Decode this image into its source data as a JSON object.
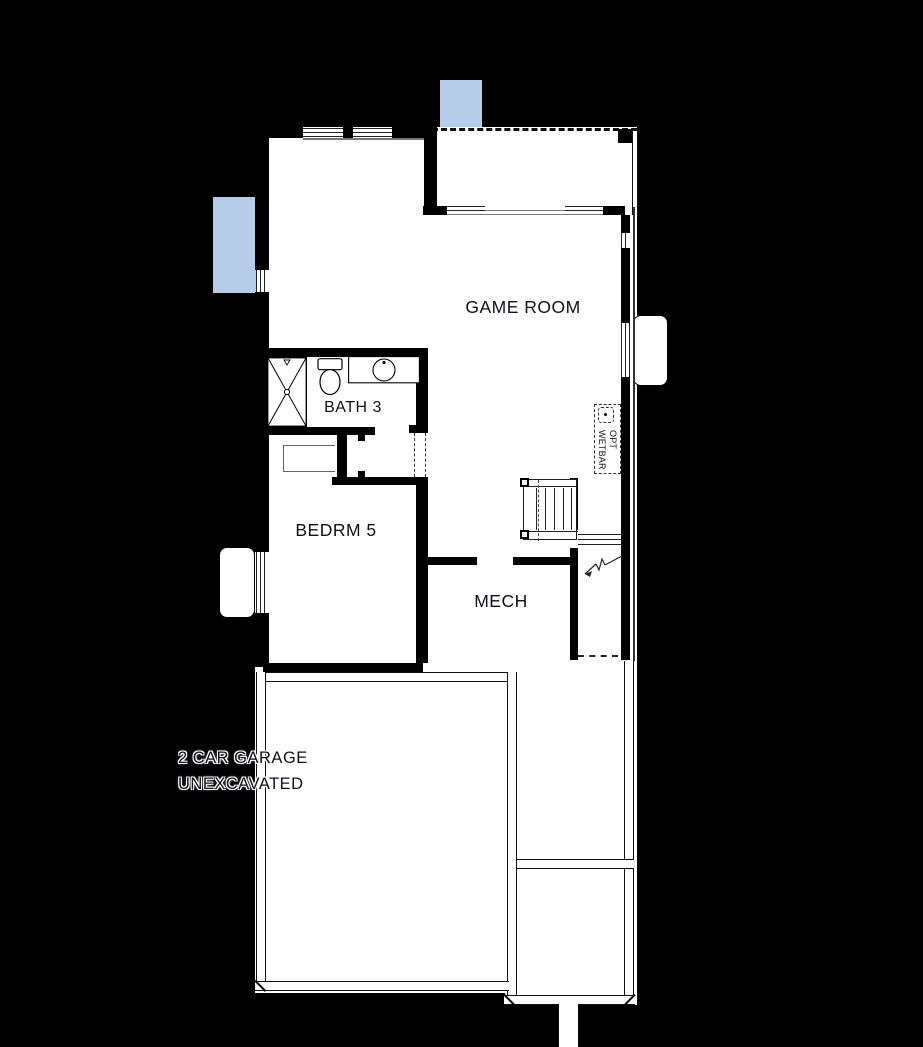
{
  "rooms": {
    "game_room": {
      "label": "GAME ROOM"
    },
    "bath": {
      "label": "BATH 3"
    },
    "bedroom": {
      "label": "BEDRM 5"
    },
    "mech": {
      "label": "MECH"
    },
    "garage": {
      "line1": "2 CAR GARAGE",
      "line2": "UNEXCAVATED"
    }
  },
  "annotations": {
    "opt_wetbar": {
      "line1": "OPT",
      "line2": "WETBAR"
    }
  },
  "colors": {
    "bg": "#000000",
    "floor": "#ffffff",
    "wallc": "#000000",
    "well": "#b5cde8",
    "ink": "#10101a"
  }
}
